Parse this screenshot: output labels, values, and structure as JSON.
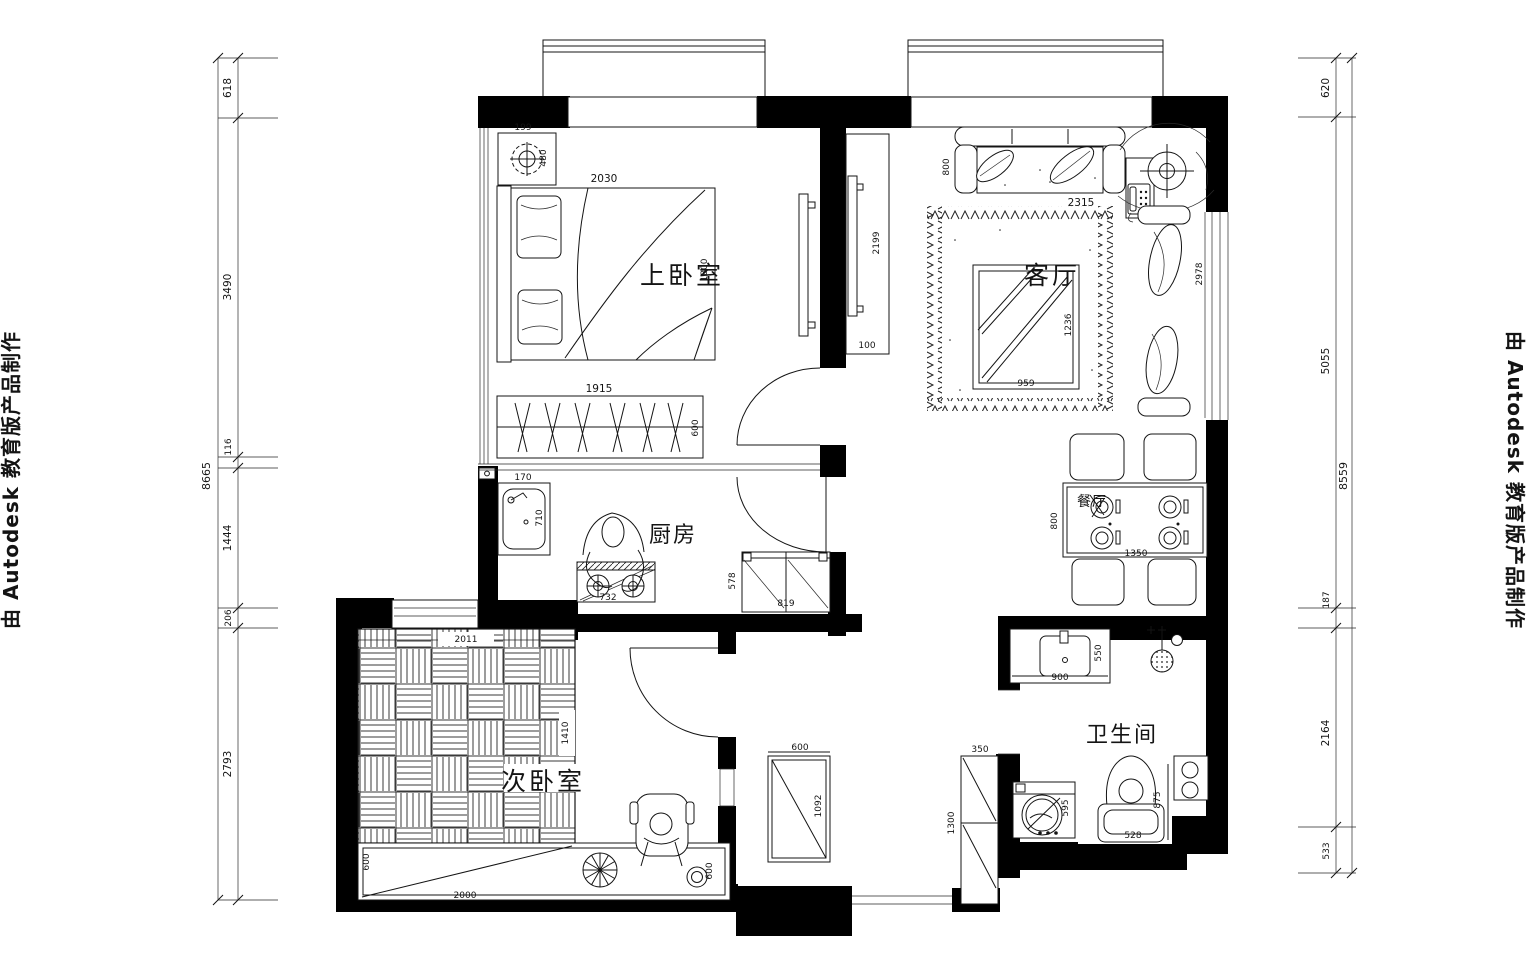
{
  "watermark": {
    "text": "由 Autodesk 教育版产品制作"
  },
  "chains": {
    "left_total": "8665",
    "left": [
      "618",
      "3490",
      "116",
      "1444",
      "206",
      "2793"
    ],
    "right_total": "8559",
    "right": [
      "620",
      "5055",
      "187",
      "2164",
      "533"
    ]
  },
  "rooms": {
    "master_bedroom": {
      "label": "上卧室"
    },
    "living_room": {
      "label": "客厅"
    },
    "kitchen": {
      "label": "厨房"
    },
    "dining": {
      "label": "餐厅"
    },
    "second_bedroom": {
      "label": "次卧室"
    },
    "bathroom": {
      "label": "卫生间"
    }
  },
  "dims": {
    "master_bedroom": {
      "nightstand": "199",
      "lamp": "480",
      "bed_width": "2030",
      "bed_length": "1800",
      "wardrobe": "1915",
      "wardrobe_depth": "600"
    },
    "living_room": {
      "sofa_depth": "800",
      "sofa_length": "2315",
      "tv_wall_length": "2199",
      "tv_wall_depth": "100",
      "coffee_table_width": "959",
      "coffee_table_length": "1236",
      "chaise_length": "2978"
    },
    "kitchen": {
      "sink_width": "170",
      "sink_length": "710",
      "stove": "732",
      "cabinet_depth": "578",
      "cabinet_width": "819"
    },
    "dining": {
      "table_depth": "800",
      "table_width": "1350"
    },
    "second_bedroom": {
      "bed_width": "2011",
      "bed_length": "1410",
      "desk_depth_left": "600",
      "desk_length": "2000",
      "desk_depth_right": "600",
      "cabinet_width": "600",
      "cabinet_length": "1092"
    },
    "bathroom": {
      "vanity_width": "900",
      "vanity_depth": "550",
      "washer": "595",
      "toilet_width": "528",
      "toilet_depth": "875",
      "cabinet_width": "350",
      "cabinet_length": "1300"
    }
  }
}
